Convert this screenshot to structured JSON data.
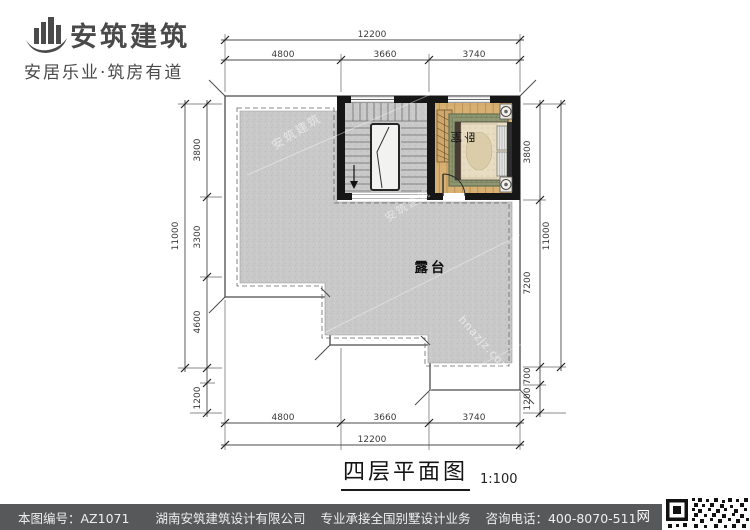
{
  "logo": {
    "name": "安筑建筑",
    "tagline": "安居乐业·筑房有道"
  },
  "drawing": {
    "title": "四层平面图",
    "scale": "1:100",
    "rooms": {
      "terrace": "露台",
      "bedroom": "卧室"
    },
    "dimensions": {
      "top": {
        "total": "12200",
        "segments": [
          "4800",
          "3660",
          "3740"
        ]
      },
      "bottom": {
        "total": "12200",
        "segments": [
          "4800",
          "3660",
          "3740"
        ]
      },
      "left": {
        "total": "11000",
        "segments": [
          "3800",
          "3300",
          "4600",
          "1200"
        ]
      },
      "right": {
        "total": "11000",
        "segments": [
          "3800",
          "7200",
          "700",
          "1200"
        ]
      }
    },
    "watermarks": [
      "安筑建筑",
      "安筑建筑",
      "hnazjz.com"
    ]
  },
  "footer": {
    "drawing_no": "本图编号：AZ1071",
    "company": "湖南安筑建筑设计有限公司",
    "service": "专业承接全国别墅设计业务",
    "phone": "咨询电话：400-8070-511",
    "qr_label": "网"
  },
  "colors": {
    "wall": "#161616",
    "terrace_floor": "#c9c9c9",
    "wood_floor": "#d8b072",
    "rug": "#8d9571",
    "footer_bg": "#57585a",
    "dim_text": "#3a3a3a"
  }
}
